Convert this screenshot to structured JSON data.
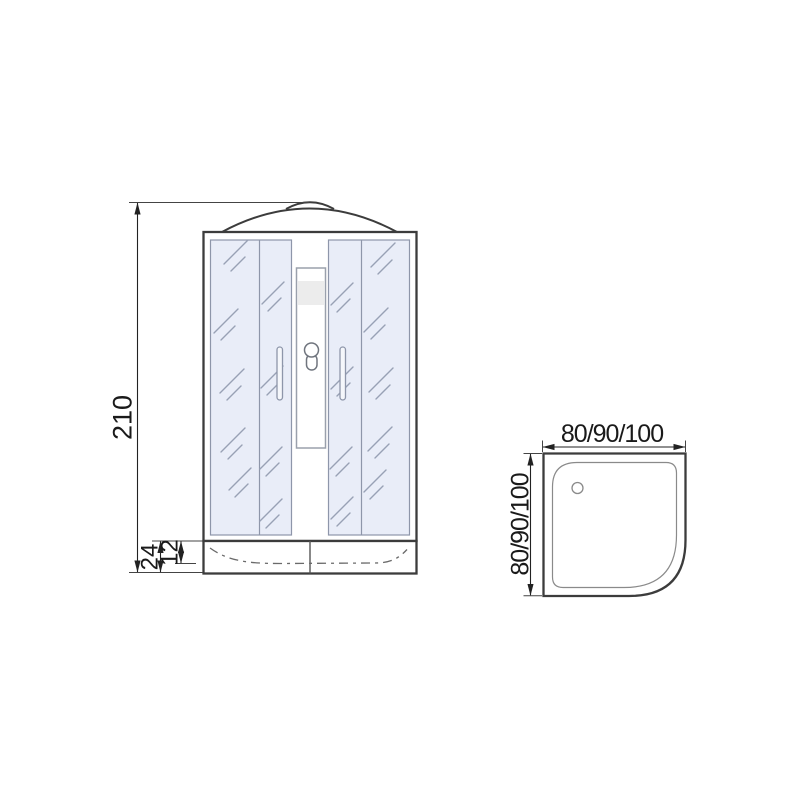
{
  "title": "Shower cabin technical drawing",
  "front_view": {
    "name": "front-elevation",
    "dims": {
      "height": "210",
      "tray_height": "24",
      "tray_inner_height": "12"
    }
  },
  "top_view": {
    "name": "tray-plan-view",
    "dims": {
      "width": "80/90/100",
      "depth": "80/90/100"
    }
  },
  "colors": {
    "outline": "#3c3c3c",
    "dimension_line": "#222222",
    "glass_fill": "#e9edf8",
    "glass_stroke": "#8e96aa",
    "background": "#ffffff"
  }
}
